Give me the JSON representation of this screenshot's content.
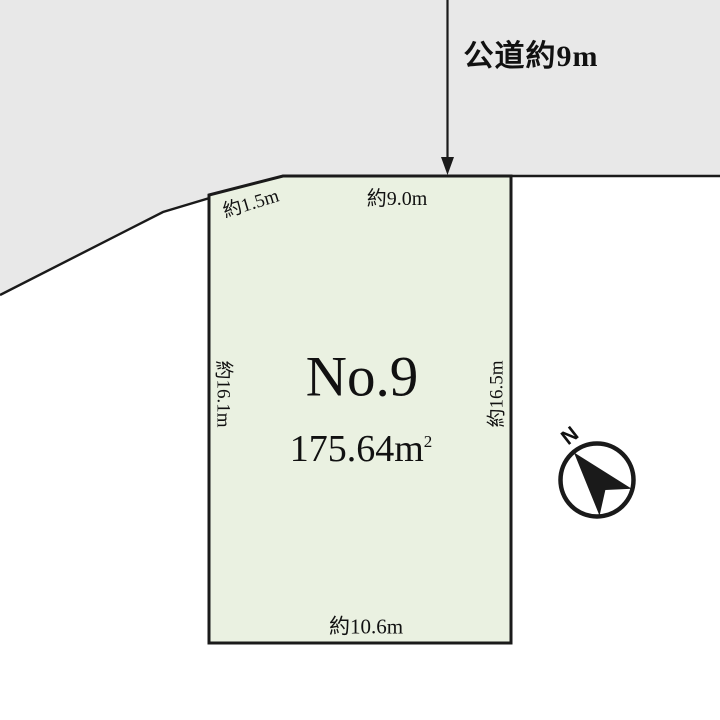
{
  "diagram": {
    "road_label": "公道約9m",
    "plot": {
      "name": "No.9",
      "area_value": "175.64",
      "area_unit_base": "m",
      "area_unit_sup": "2"
    },
    "dimensions": {
      "top_cut": "約1.5m",
      "top": "約9.0m",
      "left": "約16.1m",
      "right": "約16.5m",
      "bottom": "約10.6m"
    },
    "compass": {
      "north": "N"
    },
    "colors": {
      "road_fill": "#e8e8e8",
      "plot_fill": "#eaf1e1",
      "line": "#1a1a1a",
      "white": "#ffffff"
    }
  }
}
